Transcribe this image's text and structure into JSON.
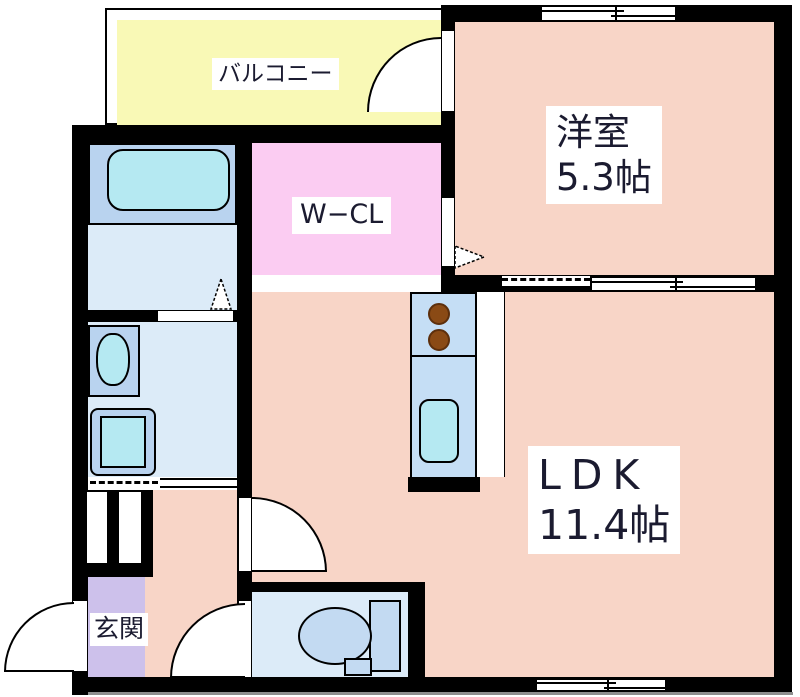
{
  "plan_title": "1LDK apartment floor plan",
  "rooms": {
    "balcony": {
      "label": "バルコニー"
    },
    "western_room": {
      "label": "洋室",
      "size": "5.3帖"
    },
    "walk_in_closet": {
      "label": "W−CL"
    },
    "ldk": {
      "label": "LDK",
      "size": "11.4帖"
    },
    "entrance": {
      "label": "玄関"
    }
  },
  "fixture_icons": {
    "bathtub": "bathtub-icon",
    "washbasin": "washbasin-icon",
    "washing_machine": "washing-machine-icon",
    "stove_burners": "stove-burner-icon",
    "kitchen_sink": "kitchen-sink-icon",
    "toilet": "toilet-icon"
  },
  "colors": {
    "wall": "#000000",
    "room_salmon": "#f8d5c7",
    "balcony_yellow": "#f9f9b6",
    "closet_pink": "#fbccf2",
    "wet_area_blue": "#dcebf8",
    "fixture_panel_blue": "#b9d3ef",
    "fixture_cyan": "#b5e9f2",
    "kitchen_counter_blue": "#c5def5",
    "entrance_purple": "#cdc1eb",
    "toilet_porcelain_blue": "#c3daf2",
    "burner_brown": "#8a4a15",
    "ground_line_grey": "#8e8e8e"
  }
}
